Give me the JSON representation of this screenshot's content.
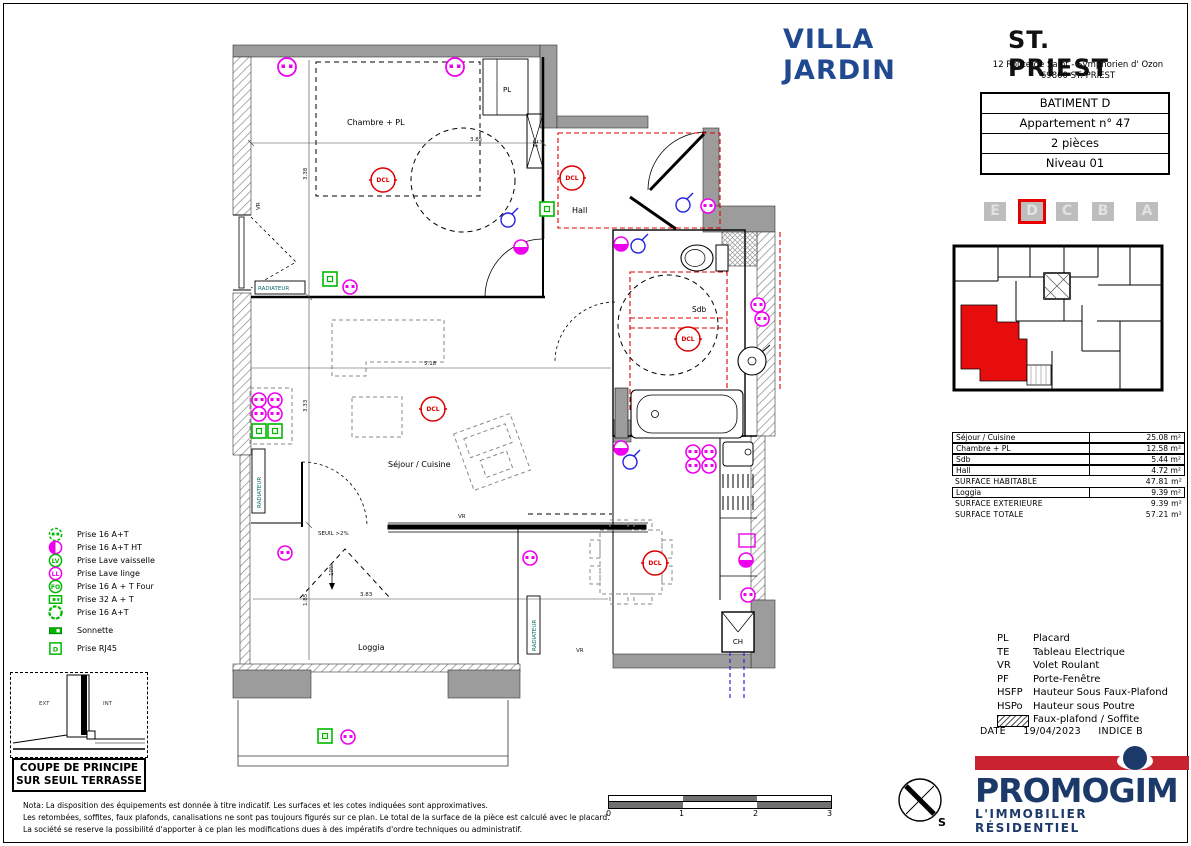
{
  "header": {
    "project": "VILLA JARDIN",
    "city": "ST. PRIEST",
    "address_line1": "12 Route de Saint - Symphorien d' Ozon",
    "address_line2": "69800 ST. PRIEST"
  },
  "info_box": {
    "building": "BATIMENT D",
    "apartment": "Appartement n° 47",
    "rooms": "2 pièces",
    "level": "Niveau 01"
  },
  "building_tabs": {
    "letters": [
      "E",
      "D",
      "C",
      "B",
      "A"
    ],
    "active": "D"
  },
  "surface_table": {
    "rows": [
      {
        "label": "Séjour / Cuisine",
        "value": "25.08 m²"
      },
      {
        "label": "Chambre + PL",
        "value": "12.58 m²"
      },
      {
        "label": "Sdb",
        "value": "5.44 m²"
      },
      {
        "label": "Hall",
        "value": "4.72 m²"
      },
      {
        "label": "SURFACE HABITABLE",
        "value": "47.81 m²"
      },
      {
        "label": "Loggia",
        "value": "9.39 m²"
      },
      {
        "label": "SURFACE EXTERIEURE",
        "value": "9.39 m²"
      },
      {
        "label": "SURFACE TOTALE",
        "value": "57.21 m²"
      }
    ]
  },
  "abbreviations": [
    {
      "abbr": "PL",
      "label": "Placard"
    },
    {
      "abbr": "TE",
      "label": "Tableau Electrique"
    },
    {
      "abbr": "VR",
      "label": "Volet Roulant"
    },
    {
      "abbr": "PF",
      "label": "Porte-Fenêtre"
    },
    {
      "abbr": "HSFP",
      "label": "Hauteur Sous Faux-Plafond"
    },
    {
      "abbr": "HSPo",
      "label": "Hauteur sous Poutre"
    },
    {
      "abbr": "",
      "label": "Faux-plafond / Soffite"
    }
  ],
  "date_row": {
    "label": "DATE",
    "date": "19/04/2023",
    "indice": "INDICE B"
  },
  "logo": {
    "name": "PROMOGIM",
    "tagline": "L'IMMOBILIER RÉSIDENTIEL"
  },
  "electrical_legend": [
    {
      "icon": "socket-16at-icon",
      "icon_text": "",
      "label": "Prise 16 A+T"
    },
    {
      "icon": "socket-16at-ht-icon",
      "icon_text": "",
      "label": "Prise 16 A+T HT"
    },
    {
      "icon": "socket-dishwasher-icon",
      "icon_text": "LV",
      "label": "Prise Lave vaisselle"
    },
    {
      "icon": "socket-washer-icon",
      "icon_text": "LL",
      "label": "Prise Lave linge"
    },
    {
      "icon": "socket-oven-icon",
      "icon_text": "FO",
      "label": "Prise 16 A + T Four"
    },
    {
      "icon": "socket-32at-icon",
      "icon_text": "",
      "label": "Prise 32 A + T"
    },
    {
      "icon": "socket-16at-b-icon",
      "icon_text": "",
      "label": "Prise 16 A+T"
    },
    {
      "icon": "doorbell-icon",
      "icon_text": "",
      "label": "Sonnette"
    },
    {
      "icon": "socket-rj45-icon",
      "icon_text": "D",
      "label": "Prise RJ45"
    }
  ],
  "coupe_box": {
    "line1": "COUPE DE PRINCIPE",
    "line2": "SUR SEUIL TERRASSE",
    "ext": "EXT",
    "int": "INT"
  },
  "notes": [
    "Nota: La disposition des équipements est donnée à titre indicatif. Les surfaces et les cotes indiquées sont approximatives.",
    "Les retombées, soffites, faux plafonds, canalisations ne sont pas toujours figurés sur ce plan. Le total de la surface de la pièce est calculé avec le placard.",
    "La société se reserve la possibilité d'apporter à ce plan les modifications dues à des impératifs d'ordre techniques ou administratif."
  ],
  "scale_bar": {
    "ticks": [
      "0",
      "1",
      "2",
      "3"
    ]
  },
  "compass": {
    "south": "S"
  },
  "plan": {
    "rooms": {
      "chambre": "Chambre + PL",
      "hall": "Hall",
      "sdb": "Sdb",
      "sejour": "Séjour / Cuisine",
      "loggia": "Loggia"
    },
    "labels": {
      "pl": "PL",
      "te": "TE",
      "ch": "CH",
      "dcl": "DCL",
      "vr": "VR",
      "radiateur": "RADIATEUR",
      "seuil": "SEUIL >2%",
      "ramp": "10%"
    },
    "dimensions": {
      "chambre_w": "3.85",
      "chambre_h": "3.38",
      "sejour_w": "5.18",
      "sejour_h": "3.33",
      "loggia_w": "3.83",
      "loggia_h": "1.85"
    }
  },
  "colors": {
    "brand_blue": "#20498f",
    "logo_navy": "#1c3a69",
    "logo_red": "#c92332",
    "plan_red": "#dd0000",
    "symbol_magenta": "#ee00ee",
    "symbol_green": "#00b800",
    "symbol_blue": "#2424dd",
    "wall_gray": "#9c9c9c"
  }
}
